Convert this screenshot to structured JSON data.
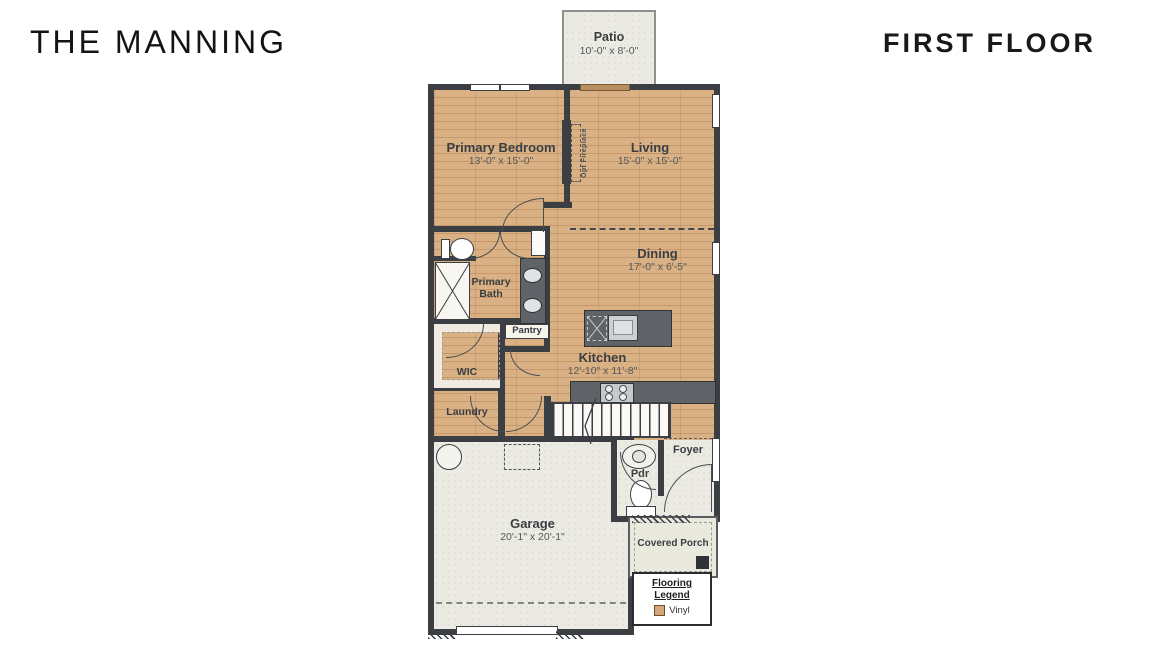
{
  "header": {
    "plan_name": "THE MANNING",
    "floor_label": "FIRST FLOOR"
  },
  "rooms": {
    "patio": {
      "name": "Patio",
      "dims": "10'-0\" x 8'-0\""
    },
    "primary_bedroom": {
      "name": "Primary Bedroom",
      "dims": "13'-0\" x 15'-0\""
    },
    "living": {
      "name": "Living",
      "dims": "15'-0\" x 15'-0\""
    },
    "dining": {
      "name": "Dining",
      "dims": "17'-0\" x 6'-5\""
    },
    "kitchen": {
      "name": "Kitchen",
      "dims": "12'-10\" x 11'-8\""
    },
    "primary_bath": {
      "name": "Primary Bath"
    },
    "pantry": {
      "name": "Pantry"
    },
    "wic": {
      "name": "WIC"
    },
    "laundry": {
      "name": "Laundry"
    },
    "foyer": {
      "name": "Foyer"
    },
    "powder_room": {
      "name": "Pdr"
    },
    "garage": {
      "name": "Garage",
      "dims": "20'-1\" x 20'-1\""
    },
    "covered_porch": {
      "name": "Covered Porch"
    }
  },
  "annotations": {
    "fireplace": "Opt Fireplace"
  },
  "legend": {
    "title": "Flooring Legend",
    "items": [
      {
        "label": "Vinyl",
        "swatch_color": "#d4a678"
      }
    ]
  },
  "colors": {
    "wood_floor": "#d9b184",
    "wall": "#3b3f44",
    "concrete": "#ebebe3",
    "counter": "#5f6367",
    "patio_door": "#b98e5f"
  }
}
